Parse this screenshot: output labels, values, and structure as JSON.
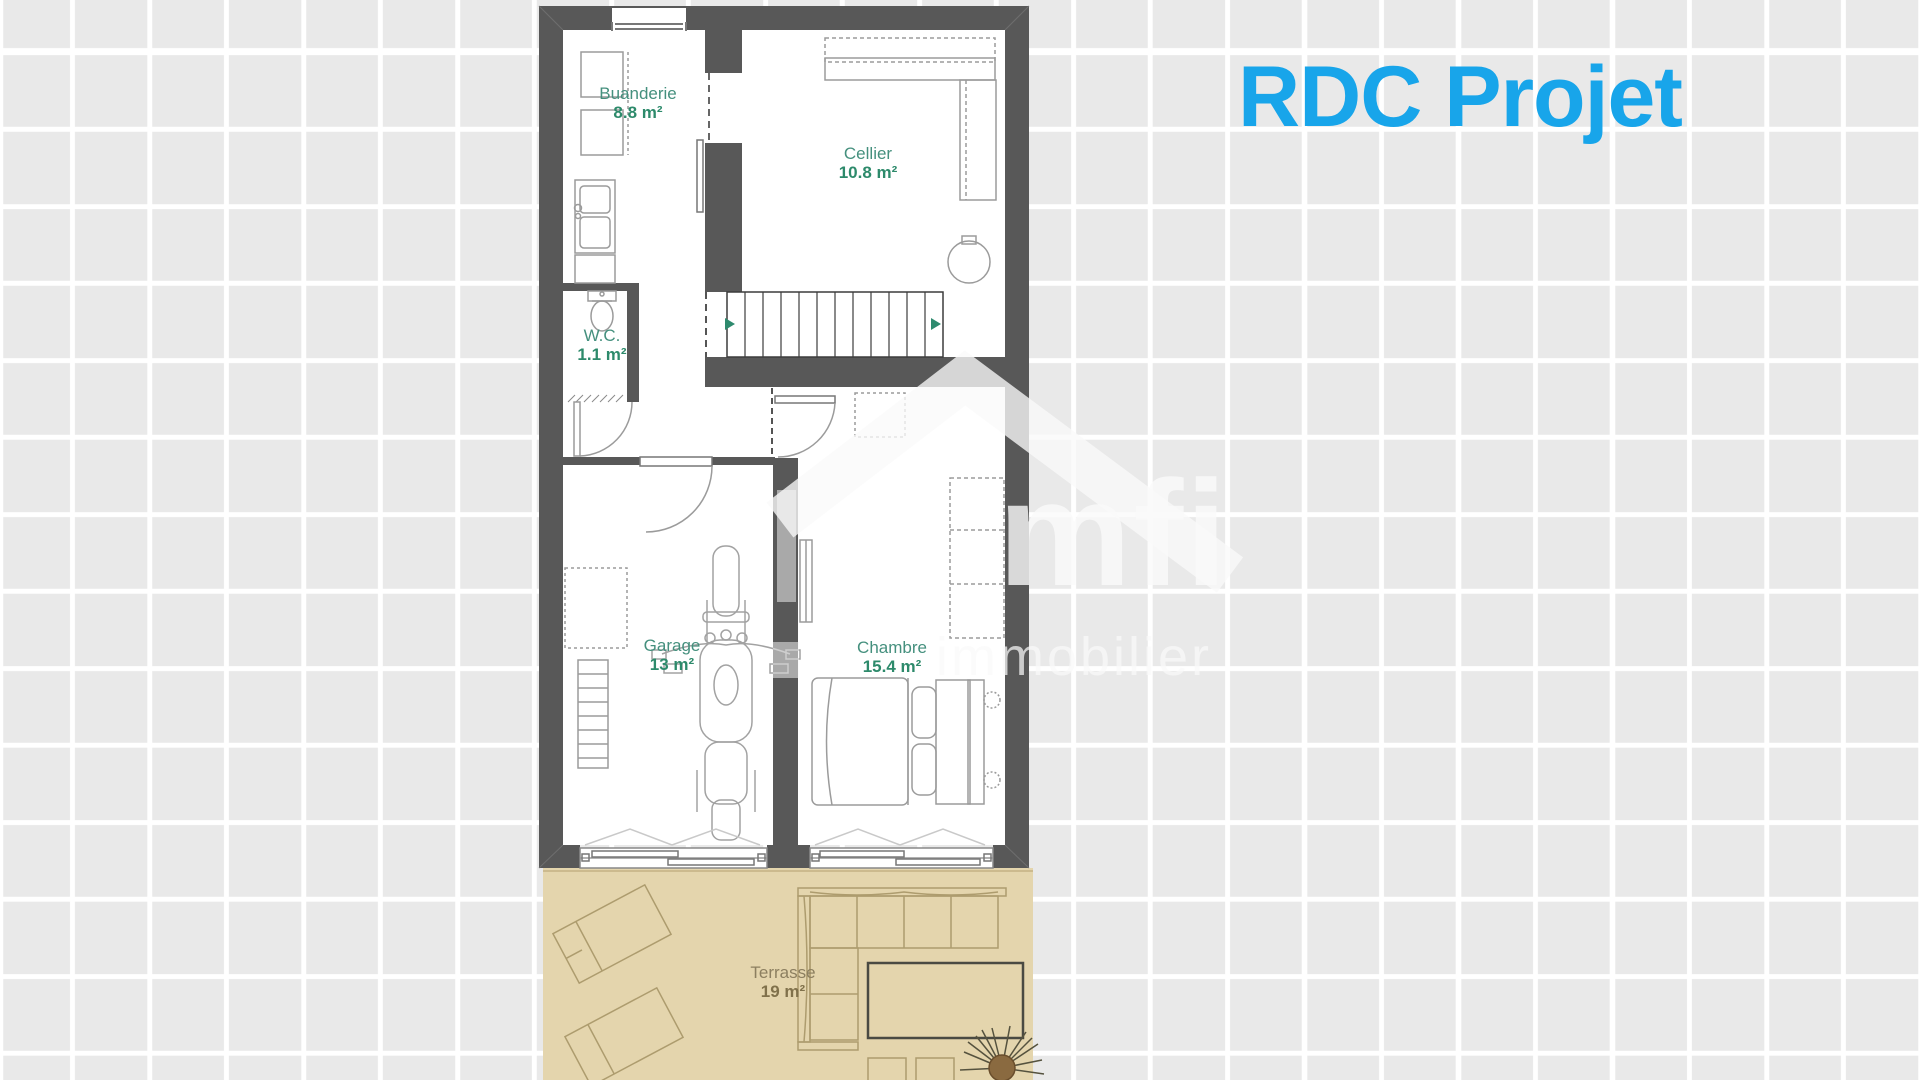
{
  "title": "RDC Projet",
  "watermark": {
    "brand": "mfi",
    "tagline": "immobilier"
  },
  "rooms": {
    "buanderie": {
      "name": "Buanderie",
      "area": "8.8 m²"
    },
    "cellier": {
      "name": "Cellier",
      "area": "10.8 m²"
    },
    "wc": {
      "name": "W.C.",
      "area": "1.1 m²"
    },
    "garage": {
      "name": "Garage",
      "area": "13 m²"
    },
    "chambre": {
      "name": "Chambre",
      "area": "15.4 m²"
    },
    "terrasse": {
      "name": "Terrasse",
      "area": "19 m²"
    }
  },
  "colors": {
    "title": "#18a5ea",
    "room_label": "#45907e",
    "room_area": "#2d8a6b",
    "terrace_label": "#8c7f60",
    "wall": "#585858",
    "terrace_floor": "#e4d5ad",
    "background": "#e9e9e9",
    "grid_line": "#ffffff",
    "stairs_arrow": "#2e8a6e"
  }
}
